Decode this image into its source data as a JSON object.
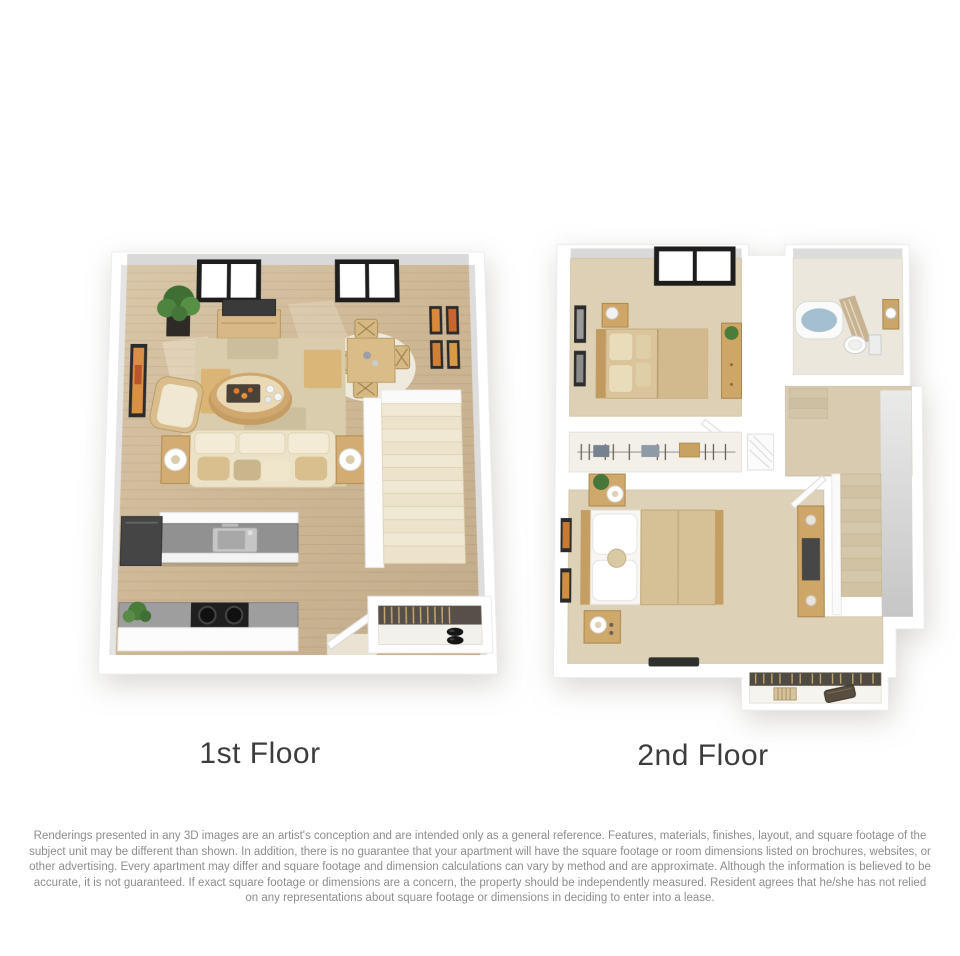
{
  "page": {
    "background_color": "#ffffff"
  },
  "floorplans": [
    {
      "label": "1st Floor",
      "rooms": [
        "living room",
        "dining area",
        "kitchen",
        "entry",
        "staircase"
      ],
      "features": [
        "two windows",
        "potted plant",
        "tv console with television",
        "framed wall art",
        "patchwork area rug",
        "oval coffee table with tray",
        "three-seat sofa with pillows",
        "armchair",
        "two side tables with ring lamps",
        "dining table with four chairs",
        "round dining rug",
        "gallery of four frames",
        "carpeted stairs with railing wall",
        "kitchen island with sink",
        "refrigerator",
        "counter with cooktop",
        "counter plant",
        "open entry door",
        "entry closet with hangers and shoes"
      ]
    },
    {
      "label": "2nd Floor",
      "rooms": [
        "bedroom",
        "bathroom",
        "hall closet",
        "hallway",
        "staircase",
        "master bedroom",
        "closet nook"
      ],
      "features": [
        "bedroom window",
        "bed with tan bedding",
        "nightstand with lamp",
        "two framed pictures",
        "dresser with plant",
        "bathtub with shower curtain",
        "toilet",
        "vanity sink",
        "hall closet with hangers and linens",
        "linen shelf",
        "landing and descending stairs",
        "master bed with white pillows and tan comforter",
        "two nightstands with lamps",
        "framed art pair",
        "media console",
        "dark floor mat",
        "closet nook with hangers, basket and storage box"
      ]
    }
  ],
  "disclaimer": {
    "text": "Renderings presented in any 3D images are an artist's conception and are intended only as a general reference. Features, materials, finishes, layout, and square footage of the subject unit may be different than shown. In addition, there is no guarantee that your apartment will have the square footage or room dimensions listed on brochures, websites, or other advertising. Every apartment may differ and square footage and dimension calculations can vary by method and are approximate. Although the information is believed to be accurate, it is not guaranteed. If exact square footage or dimensions are a concern, the property should be independently measured. Resident agrees that he/she has not relied on any representations about square footage or dimensions in deciding to enter into a lease."
  },
  "colors": {
    "wood_floor": "#cdb795",
    "carpet": "#ddd0b4",
    "rug": "#d9cdad",
    "wall": "#ffffff",
    "accent_wood": "#d2ad72",
    "counter_gray": "#949494",
    "stair_carpet": "#ece3cc",
    "label_text": "#3d3d3d",
    "disclaimer_text": "#8d8d8d"
  }
}
